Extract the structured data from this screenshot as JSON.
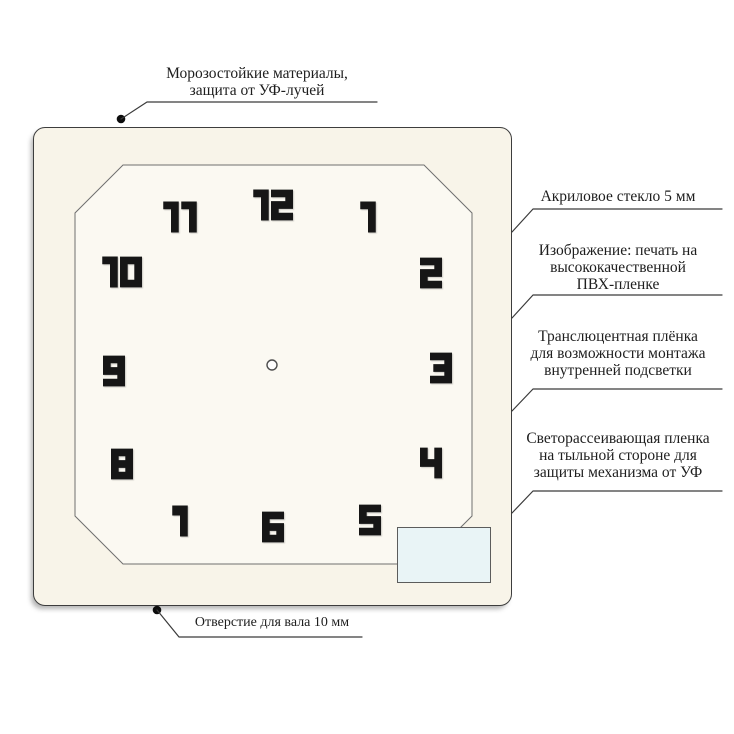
{
  "clock_face": {
    "numbers": [
      "12",
      "1",
      "2",
      "3",
      "4",
      "5",
      "6",
      "7",
      "8",
      "9",
      "10",
      "11"
    ]
  },
  "annotations": {
    "frost_protection": "Морозостойкие материалы,\nзащита от УФ-лучей",
    "acrylic_glass": "Акриловое стекло 5 мм",
    "pvc_print": "Изображение: печать на\nвысококачественной\nПВХ-пленке",
    "translucent_film": "Транслюцентная плёнка\nдля возможности монтажа\nвнутренней подсветки",
    "diffuser_film": "Светорассеивающая пленка\nна тыльной стороне для\nзащиты механизма от УФ",
    "shaft_hole": "Отверстие для вала 10 мм"
  },
  "colors": {
    "frame_fill": "#f8f4e9",
    "face_fill": "#fbf9f2",
    "outline": "#3d3d3d",
    "number_color": "#161616",
    "mechanism_box_fill": "#e9f4f6"
  }
}
